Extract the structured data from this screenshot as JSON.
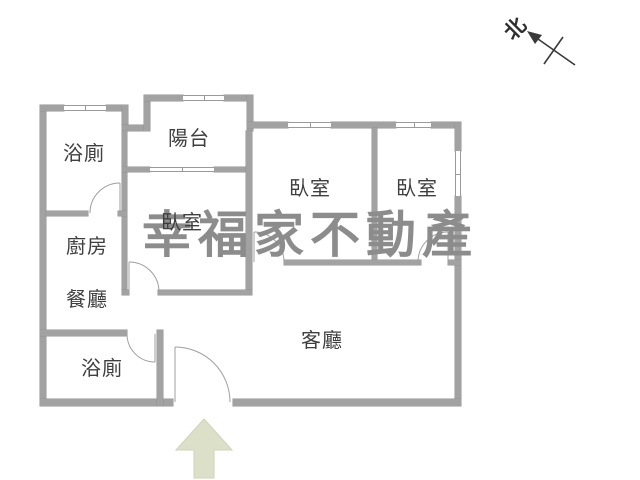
{
  "plan": {
    "rooms": [
      {
        "id": "bath-top",
        "label": "浴廁"
      },
      {
        "id": "balcony",
        "label": "陽台"
      },
      {
        "id": "bedroom-left",
        "label": "臥室"
      },
      {
        "id": "bedroom-middle",
        "label": "臥室"
      },
      {
        "id": "bedroom-right",
        "label": "臥室"
      },
      {
        "id": "kitchen",
        "label": "廚房"
      },
      {
        "id": "dining",
        "label": "餐廳"
      },
      {
        "id": "bath-bottom",
        "label": "浴廁"
      },
      {
        "id": "living",
        "label": "客廳"
      }
    ],
    "north_label": "北",
    "watermark": "幸福家不動產",
    "colors": {
      "wall": "#a2a2a2",
      "wall_edge": "#939393",
      "door_line": "#9f9f9f",
      "label_text": "#3f3f3f",
      "watermark": "#8c8c8c",
      "entry_arrow": "#dde0c9",
      "north_mark": "#3a3a3a",
      "background": "#ffffff"
    }
  }
}
